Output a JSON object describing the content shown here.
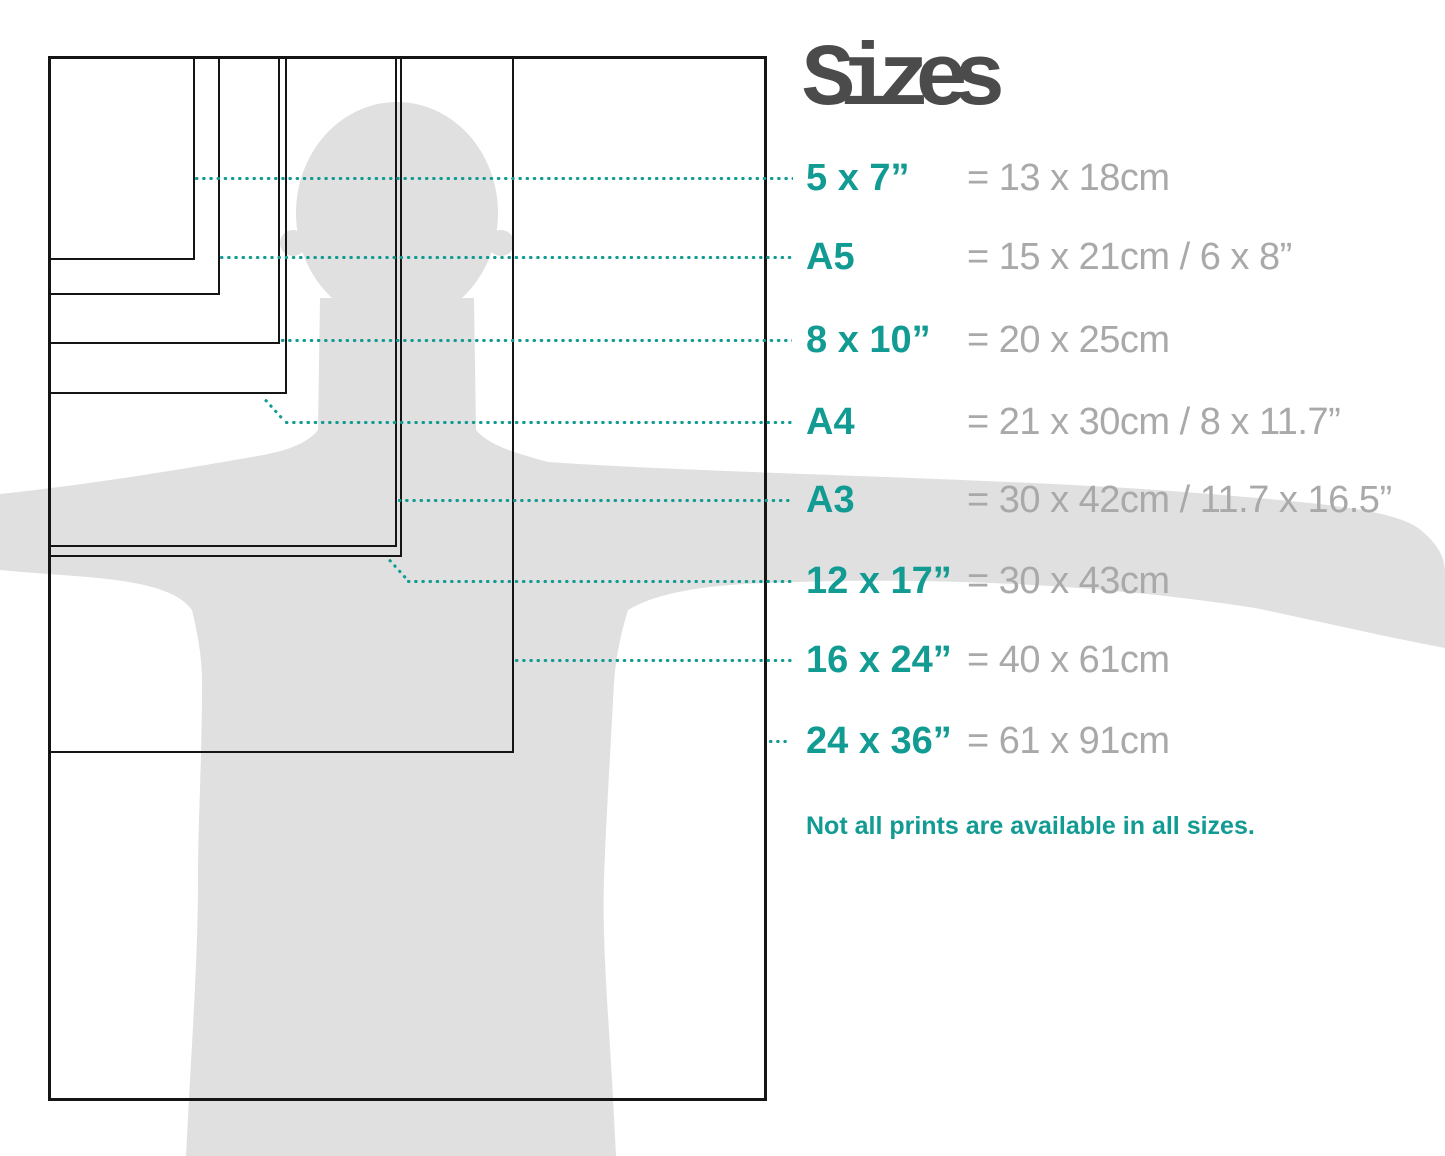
{
  "title": "Sizes",
  "note": "Not all prints are available in all sizes.",
  "colors": {
    "accent_teal": "#119b93",
    "metric_gray": "#a9a9a9",
    "title_gray": "#4b4b4b",
    "silhouette_gray": "#e0e0e0",
    "rect_border": "#151515"
  },
  "sizes": [
    {
      "id": "5x7",
      "label": "5 x 7”",
      "metric": "= 13 x 18cm"
    },
    {
      "id": "a5",
      "label": "A5",
      "metric": "= 15 x 21cm / 6 x 8”"
    },
    {
      "id": "8x10",
      "label": "8 x 10”",
      "metric": "= 20 x 25cm"
    },
    {
      "id": "a4",
      "label": "A4",
      "metric": "= 21 x 30cm / 8 x 11.7”"
    },
    {
      "id": "a3",
      "label": "A3",
      "metric": "= 30 x 42cm / 11.7 x 16.5”"
    },
    {
      "id": "12x17",
      "label": "12 x 17”",
      "metric": "= 30 x 43cm"
    },
    {
      "id": "16x24",
      "label": "16 x 24”",
      "metric": "= 40 x 61cm"
    },
    {
      "id": "24x36",
      "label": "24 x 36”",
      "metric": "= 61 x 91cm"
    }
  ]
}
